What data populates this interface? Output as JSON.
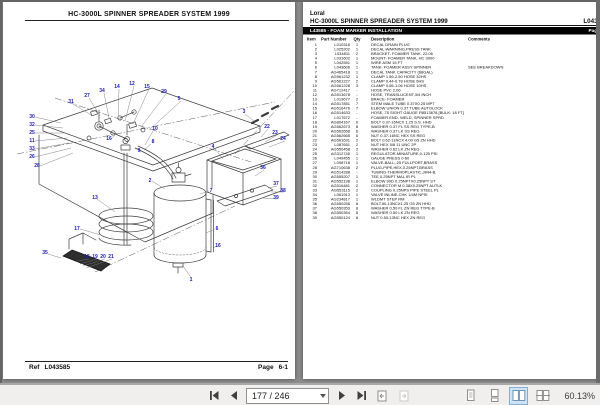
{
  "statusbar": {
    "page_field": "177 / 246",
    "zoom_label": "60.13%"
  },
  "left_page": {
    "title": "HC-3000L SPINNER SPREADER SYSTEM 1999",
    "footer": {
      "ref_label": "Ref",
      "ref_value": "L043585",
      "page_label": "Page",
      "page_value": "6-1"
    },
    "diagram_callouts": [
      {
        "n": "30",
        "x": 29,
        "y": 116
      },
      {
        "n": "32",
        "x": 29,
        "y": 124
      },
      {
        "n": "25",
        "x": 29,
        "y": 132
      },
      {
        "n": "11",
        "x": 29,
        "y": 140
      },
      {
        "n": "33",
        "x": 29,
        "y": 148
      },
      {
        "n": "26",
        "x": 29,
        "y": 156
      },
      {
        "n": "28",
        "x": 34,
        "y": 165
      },
      {
        "n": "31",
        "x": 68,
        "y": 101
      },
      {
        "n": "27",
        "x": 84,
        "y": 95
      },
      {
        "n": "34",
        "x": 99,
        "y": 90
      },
      {
        "n": "14",
        "x": 114,
        "y": 86
      },
      {
        "n": "12",
        "x": 129,
        "y": 83
      },
      {
        "n": "15",
        "x": 144,
        "y": 86
      },
      {
        "n": "29",
        "x": 161,
        "y": 91
      },
      {
        "n": "5",
        "x": 176,
        "y": 98
      },
      {
        "n": "16",
        "x": 106,
        "y": 138
      },
      {
        "n": "10",
        "x": 152,
        "y": 128
      },
      {
        "n": "8",
        "x": 150,
        "y": 141
      },
      {
        "n": "9",
        "x": 136,
        "y": 150
      },
      {
        "n": "2",
        "x": 147,
        "y": 180
      },
      {
        "n": "7",
        "x": 208,
        "y": 190
      },
      {
        "n": "6",
        "x": 214,
        "y": 228
      },
      {
        "n": "16",
        "x": 215,
        "y": 245
      },
      {
        "n": "1",
        "x": 188,
        "y": 279
      },
      {
        "n": "13",
        "x": 92,
        "y": 197
      },
      {
        "n": "17",
        "x": 74,
        "y": 228
      },
      {
        "n": "35",
        "x": 42,
        "y": 252
      },
      {
        "n": "18",
        "x": 84,
        "y": 256
      },
      {
        "n": "19",
        "x": 92,
        "y": 256
      },
      {
        "n": "20",
        "x": 100,
        "y": 256
      },
      {
        "n": "21",
        "x": 108,
        "y": 256
      },
      {
        "n": "4",
        "x": 210,
        "y": 146
      },
      {
        "n": "3",
        "x": 241,
        "y": 111
      },
      {
        "n": "22",
        "x": 264,
        "y": 126
      },
      {
        "n": "23",
        "x": 272,
        "y": 132
      },
      {
        "n": "24",
        "x": 280,
        "y": 138
      },
      {
        "n": "36",
        "x": 260,
        "y": 167
      },
      {
        "n": "37",
        "x": 273,
        "y": 183
      },
      {
        "n": "38",
        "x": 280,
        "y": 190
      },
      {
        "n": "39",
        "x": 273,
        "y": 197
      }
    ]
  },
  "right_page": {
    "brand": "Loral",
    "title": "HC-3000L SPINNER SPREADER SYSTEM 1999",
    "doc_ref": "L043585",
    "section_title": "L43585 - FOAM MARKER INSTALLATION",
    "section_page": "Page 6-1",
    "columns": {
      "item": "Item",
      "part": "Part Number",
      "qty": "Qty",
      "desc": "Description",
      "comments": "Comments"
    },
    "rows": [
      {
        "item": "1",
        "part": "L010316",
        "qty": "1",
        "desc": "DECAL DRAIN PLUG",
        "comments": ""
      },
      {
        "item": "2",
        "part": "L025202",
        "qty": "1",
        "desc": "DECAL-WARNING,PRESS TANK",
        "comments": ""
      },
      {
        "item": "3",
        "part": "L034811",
        "qty": "2",
        "desc": "BRACKET- FOAMER TANK, 22.06",
        "comments": ""
      },
      {
        "item": "4",
        "part": "L031602",
        "qty": "1",
        "desc": "MOUNT- FOAMER TANK, HC 3000",
        "comments": ""
      },
      {
        "item": "5",
        "part": "L042551",
        "qty": "1",
        "desc": "WIRE ASM 15 FT",
        "comments": ""
      },
      {
        "item": "6",
        "part": "L043606",
        "qty": "1",
        "desc": "TANK- FOAMER ASSY SPINNER",
        "comments": "SEE BREAKDOWN"
      },
      {
        "item": "7",
        "part": "AG465418",
        "qty": "1",
        "desc": "DECAL TANK CAPACITY (68GAL)",
        "comments": ""
      },
      {
        "item": "8",
        "part": "AG561232",
        "qty": "1",
        "desc": "CLAMP 1.56-2.50 HOSE 32HS",
        "comments": ""
      },
      {
        "item": "9",
        "part": "AG561227",
        "qty": "2",
        "desc": "CLAMP 0.44-0.78 HOSE  6HS",
        "comments": ""
      },
      {
        "item": "10",
        "part": "AG561228",
        "qty": "3",
        "desc": "CLAMP 0.56-1.06 HOSE 10HS",
        "comments": ""
      },
      {
        "item": "11",
        "part": "AG712417",
        "qty": "-",
        "desc": "HOSE PVC 2.06",
        "comments": ""
      },
      {
        "item": "12",
        "part": "AG513678",
        "qty": "-",
        "desc": "HOSE, TRANSLUCENT,3/4 INCH",
        "comments": ""
      },
      {
        "item": "13",
        "part": "L019677",
        "qty": "2",
        "desc": "BRACE- FOAMER",
        "comments": ""
      },
      {
        "item": "14",
        "part": "AG517851",
        "qty": "7",
        "desc": "STEM MALE TUBE 0.37X0.25 MPT",
        "comments": ""
      },
      {
        "item": "15",
        "part": "AG516476",
        "qty": "7",
        "desc": "ELBOW UNION 0.37 TUBE AUTOLOCK",
        "comments": ""
      },
      {
        "item": "16",
        "part": "AG514633",
        "qty": "-",
        "desc": "HOSE,.75 SIGHT GAUGE R8513678 [BULK: 18 FT]",
        "comments": ""
      },
      {
        "item": "17",
        "part": "L017672",
        "qty": "-",
        "desc": "FOAMER END- WELD, SPINNER SPRD",
        "comments": ""
      },
      {
        "item": "18",
        "part": "AG804167",
        "qty": "6",
        "desc": "BOLT 0.37-16NCX 1.25 S.S. HHD",
        "comments": ""
      },
      {
        "item": "19",
        "part": "AG562673",
        "qty": "8",
        "desc": "WASHER 0.37 FL SS REG TYPE-B",
        "comments": ""
      },
      {
        "item": "20",
        "part": "AG562658",
        "qty": "6",
        "desc": "WASHER 0.37 LK SS REG",
        "comments": ""
      },
      {
        "item": "21",
        "part": "AG562665",
        "qty": "6",
        "desc": "NUT 0.37-16NC HEX SS REG",
        "comments": ""
      },
      {
        "item": "22",
        "part": "AG561631",
        "qty": "2",
        "desc": "BOLT 0.62-11NCX 4.00 G5 ZN HHD",
        "comments": ""
      },
      {
        "item": "23",
        "part": "L087651",
        "qty": "2",
        "desc": "NUT HEX 5/8 11 UNC 2P",
        "comments": ""
      },
      {
        "item": "24",
        "part": "AG550458",
        "qty": "2",
        "desc": "WASHER 0.62 LK ZN REG",
        "comments": ""
      },
      {
        "item": "25",
        "part": "AG312745",
        "qty": "1",
        "desc": "REGULATOR-MINIATURE,0-125 PSI",
        "comments": ""
      },
      {
        "item": "26",
        "part": "L049455",
        "qty": "1",
        "desc": "GAUGE PRESS 0-60",
        "comments": ""
      },
      {
        "item": "27",
        "part": "L098718",
        "qty": "1",
        "desc": "VALVE-BALL,.25 FULLPORT,BRASS",
        "comments": ""
      },
      {
        "item": "28",
        "part": "AG710638",
        "qty": "2",
        "desc": "PLUG-PIPE,HEX,0.25NPT,BRASS",
        "comments": ""
      },
      {
        "item": "29",
        "part": "AG514288",
        "qty": "-",
        "desc": "TUBING-THERMOPLASTIC,J844-B,",
        "comments": ""
      },
      {
        "item": "30",
        "part": "AG555207",
        "qty": "1",
        "desc": "TEE 0.25NPT    MAL IR PL",
        "comments": ""
      },
      {
        "item": "31",
        "part": "AG552198",
        "qty": "1",
        "desc": "ELBOW 90D 0.25NPTX0.25NPT ST",
        "comments": ""
      },
      {
        "item": "32",
        "part": "AG516481",
        "qty": "2",
        "desc": "CONNECTOR M 0.38X0.25NPT AUTLK",
        "comments": ""
      },
      {
        "item": "33",
        "part": "AG553115",
        "qty": "2",
        "desc": "COUPLING 0.25NPS PIPE STEEL PL",
        "comments": ""
      },
      {
        "item": "34",
        "part": "L061913",
        "qty": "1",
        "desc": "VALVE INLINE-CHK 1/4M NPSI",
        "comments": ""
      },
      {
        "item": "35",
        "part": "AG234817",
        "qty": "1",
        "desc": "WLDMT STEP RM",
        "comments": ""
      },
      {
        "item": "36",
        "part": "AG550256",
        "qty": "8",
        "desc": "BOLT.50-13NCX1.25 G5 ZN HHD",
        "comments": ""
      },
      {
        "item": "37",
        "part": "AG550353",
        "qty": "8",
        "desc": "WASHER 0.50 FL ZN REG TYPE-B",
        "comments": ""
      },
      {
        "item": "38",
        "part": "AG550354",
        "qty": "8",
        "desc": "WASHER 0.50 LK ZN REG",
        "comments": ""
      },
      {
        "item": "39",
        "part": "AG550124",
        "qty": "8",
        "desc": "NUT 0.50-13NC HEX ZN REG",
        "comments": ""
      }
    ]
  }
}
